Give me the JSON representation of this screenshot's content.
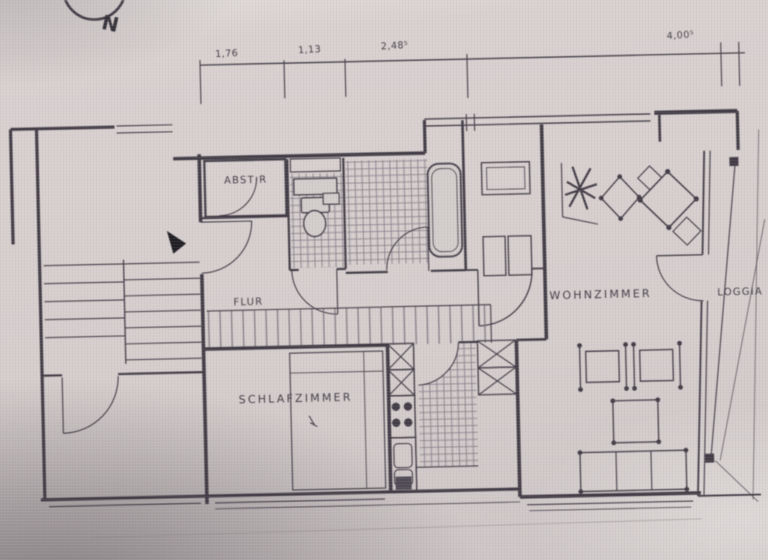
{
  "compass": {
    "label": "N"
  },
  "dimensions": {
    "values": [
      "1,76",
      "1,13",
      "2,48⁵",
      "4,00⁵"
    ]
  },
  "rooms": {
    "abstellraum": {
      "label": "ABST·R"
    },
    "flur": {
      "label": "FLUR"
    },
    "schlafzimmer": {
      "label": "SCHLAFZIMMER"
    },
    "wohnzimmer": {
      "label": "WOHNZIMMER"
    },
    "loggia": {
      "label": "LOGGIA"
    }
  },
  "colors": {
    "paper": "#d6cfce",
    "ink": "#3b3540",
    "tile": "#6f6974",
    "shadow": "#9b9495"
  }
}
